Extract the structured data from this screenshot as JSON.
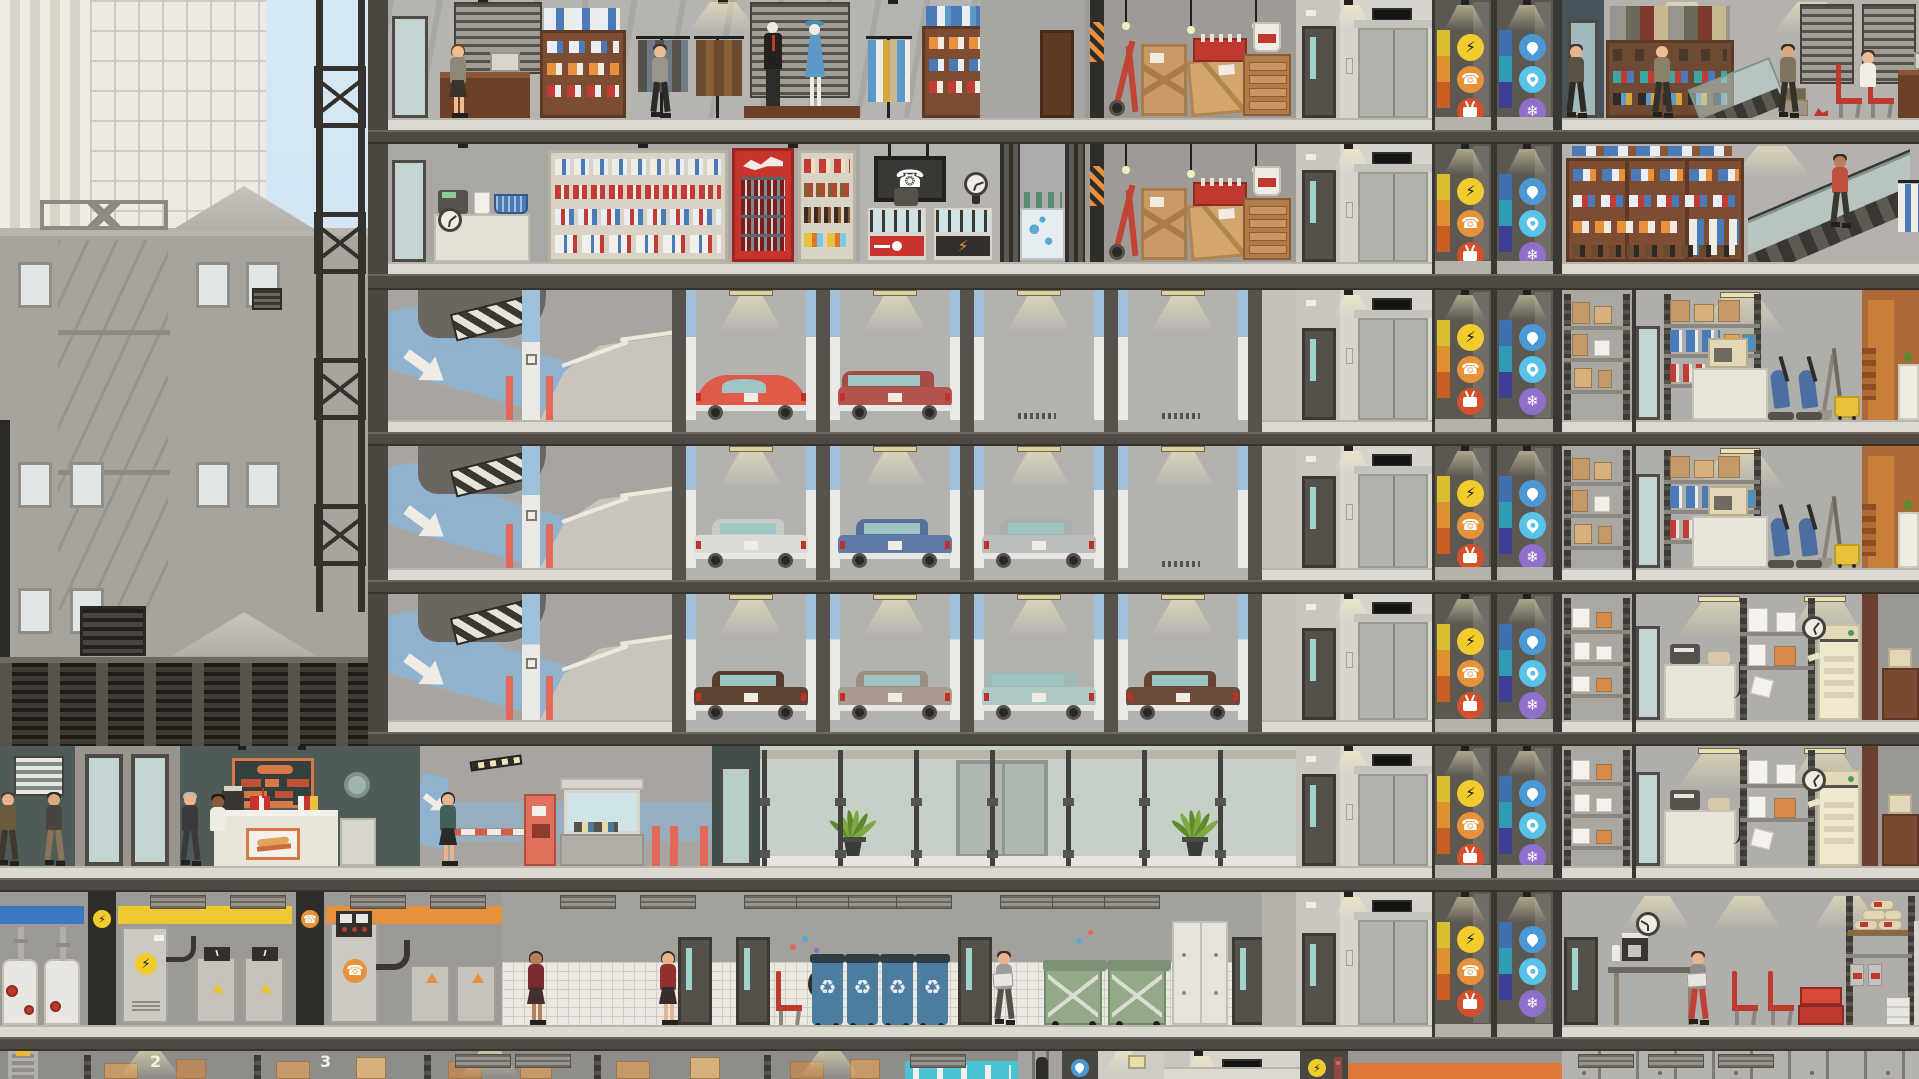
{
  "scene": {
    "title": "highrise-cross-section",
    "viewport": "building side view with city backdrop"
  },
  "storage": {
    "bays": [
      {
        "label": "2",
        "x": 150
      },
      {
        "label": "3",
        "x": 320
      },
      {
        "label": "4",
        "x": 490
      }
    ]
  },
  "risers": {
    "power": {
      "name": "electrical-riser",
      "stripes": [
        "#d9be2f",
        "#df9130",
        "#c95d22"
      ],
      "icons": [
        {
          "name": "power",
          "bg": "#f2cb2d",
          "glyph": "⚡",
          "color": "#1e1a10"
        },
        {
          "name": "phone",
          "bg": "#e5923b",
          "glyph": "☎",
          "color": "#ffffff"
        },
        {
          "name": "cable-tv",
          "bg": "#d4502a",
          "glyph": "tv",
          "color": "#ffffff"
        }
      ]
    },
    "plumbing": {
      "name": "plumbing-riser",
      "stripes": [
        "#4070b2",
        "#2f9cb4",
        "#3d4092"
      ],
      "icons": [
        {
          "name": "water",
          "bg": "#4a99d6",
          "glyph": "drop",
          "color": "#ffffff"
        },
        {
          "name": "gas",
          "bg": "#57c3e8",
          "glyph": "flame",
          "color": "#ffffff"
        },
        {
          "name": "hvac",
          "bg": "#8e6fc9",
          "glyph": "❄",
          "color": "#ffffff"
        }
      ]
    }
  },
  "parking": {
    "bay_count": 4,
    "levels": [
      {
        "name": "parking-level-1",
        "cars": [
          {
            "bay": 0,
            "style": "beetle",
            "color": "#df5a49"
          },
          {
            "bay": 1,
            "style": "wagon",
            "color": "#b2544e"
          }
        ],
        "empty_bays": [
          2,
          3
        ]
      },
      {
        "name": "parking-level-2",
        "cars": [
          {
            "bay": 0,
            "style": "sedan",
            "color": "#dbdad6"
          },
          {
            "bay": 1,
            "style": "sedan",
            "color": "#5d7aa6"
          },
          {
            "bay": 2,
            "style": "sedan",
            "color": "#babdbd"
          }
        ],
        "empty_bays": [
          3
        ]
      },
      {
        "name": "parking-level-3",
        "cars": [
          {
            "bay": 0,
            "style": "classic",
            "color": "#5f4433"
          },
          {
            "bay": 1,
            "style": "classic",
            "color": "#a99b8d"
          },
          {
            "bay": 2,
            "style": "wagon",
            "color": "#aec9c5"
          },
          {
            "bay": 3,
            "style": "classic",
            "color": "#6d4b39"
          }
        ],
        "empty_bays": []
      }
    ]
  },
  "recycling": {
    "bin_count": 4,
    "bin_color": "#4d7d9e",
    "lid_color": "#2f3d46",
    "glyph": "♻"
  },
  "trash": {
    "dumpster_count": 2,
    "dumpster_color": "#93a98a",
    "lid_color": "#7c9175"
  },
  "people": [
    {
      "floor": "f1",
      "x": 458,
      "variant": "skirt",
      "name": "clothing-clerk",
      "hair": "#6a4226",
      "skin": "#eebc92",
      "top": "#8d8878",
      "bottom": "#3a342c"
    },
    {
      "floor": "f1",
      "x": 660,
      "variant": "walk",
      "name": "clothing-shopper",
      "hair": "#3a322a",
      "skin": "#eebc92",
      "top": "#9a948a",
      "bottom": "#2c2a26"
    },
    {
      "floor": "f1",
      "x": 1576,
      "variant": "walk",
      "name": "shoe-shopper-1",
      "hair": "#3e3630",
      "skin": "#e8b48e",
      "top": "#5a5246",
      "bottom": "#2e2b26"
    },
    {
      "floor": "f1",
      "x": 1662,
      "variant": "walk",
      "name": "shoe-shopper-2",
      "hair": "#6b4a30",
      "skin": "#eebc92",
      "top": "#8a8266",
      "bottom": "#33302a"
    },
    {
      "floor": "f1",
      "x": 1788,
      "variant": "walk",
      "name": "shoe-shopper-3",
      "hair": "#2e2a26",
      "skin": "#d9a87e",
      "top": "#7d7560",
      "bottom": "#353028"
    },
    {
      "floor": "f1",
      "x": 1868,
      "variant": "half",
      "name": "shoe-cashier",
      "hair": "#3a342c",
      "skin": "#eebc92",
      "top": "#f0ede6",
      "dy": 26
    },
    {
      "floor": "f2",
      "x": 1840,
      "variant": "walk",
      "name": "escalator-rider",
      "hair": "#2e2a26",
      "skin": "#b97f5c",
      "top": "#c05040",
      "bottom": "#3a3630",
      "dy": 34
    },
    {
      "floor": "f6",
      "x": 8,
      "variant": "walk",
      "name": "pedestrian-1",
      "hair": "#4a4032",
      "skin": "#e8b48e",
      "top": "#6b5a3c",
      "bottom": "#3e382e"
    },
    {
      "floor": "f6",
      "x": 54,
      "variant": "walk",
      "name": "pedestrian-2",
      "hair": "#2e2a26",
      "skin": "#d9a87e",
      "top": "#4a4440",
      "bottom": "#8a7458"
    },
    {
      "floor": "f6",
      "x": 190,
      "variant": "walk",
      "name": "cafe-customer",
      "hair": "#b9b6b0",
      "skin": "#e8b48e",
      "top": "#3c3a38",
      "bottom": "#3c3a38"
    },
    {
      "floor": "f6",
      "x": 218,
      "variant": "half",
      "name": "cafe-server",
      "hair": "#1e1a16",
      "skin": "#8a5a3a",
      "top": "#efece4",
      "dy": 30
    },
    {
      "floor": "f6",
      "x": 448,
      "variant": "skirt",
      "name": "lobby-visitor",
      "hair": "#2c2622",
      "skin": "#e8b48e",
      "top": "#44605a",
      "bottom": "#2c2a28"
    },
    {
      "floor": "f7",
      "x": 536,
      "variant": "skirt",
      "name": "maintenance-staff-1",
      "hair": "#2c2622",
      "skin": "#b97f5c",
      "top": "#7c2b31",
      "bottom": "#452f2e"
    },
    {
      "floor": "f7",
      "x": 668,
      "variant": "skirt",
      "name": "maintenance-staff-2",
      "hair": "#2e2a26",
      "skin": "#e8b48e",
      "top": "#93302f",
      "bottom": "#3a2c2a"
    },
    {
      "floor": "f7",
      "x": 1004,
      "variant": "walk",
      "name": "janitor",
      "hair": "#3a2e24",
      "skin": "#e8b48e",
      "top": "#9c9c9a",
      "bottom": "#55524c",
      "paper": true
    },
    {
      "floor": "f7",
      "x": 1698,
      "variant": "walk",
      "name": "worker-on-break",
      "hair": "#4a3426",
      "skin": "#e8b48e",
      "top": "#8f8d88",
      "bottom": "#c23f36",
      "paper": true
    }
  ],
  "floors": [
    {
      "id": "f1",
      "rooms": [
        "clothing-store",
        "stock-room",
        "elevator-lobby",
        "electrical-riser",
        "plumbing-riser",
        "shoe-store"
      ]
    },
    {
      "id": "f2",
      "rooms": [
        "convenience-store",
        "phone-store",
        "cosmetics-stand",
        "stock-room",
        "elevator-lobby",
        "electrical-riser",
        "plumbing-riser",
        "apparel-store-with-escalator"
      ]
    },
    {
      "id": "f3",
      "rooms": [
        "parking-ramp",
        "parking-bays",
        "elevator-lobby",
        "risers",
        "supply-closet",
        "housekeeping-office",
        "cafe-sliver"
      ]
    },
    {
      "id": "f4",
      "rooms": [
        "parking-ramp",
        "parking-bays",
        "elevator-lobby",
        "risers",
        "supply-closet",
        "housekeeping-office",
        "cafe-sliver"
      ]
    },
    {
      "id": "f5",
      "rooms": [
        "parking-ramp",
        "parking-bays",
        "elevator-lobby",
        "risers",
        "paper-closet",
        "copy-room",
        "office-sliver"
      ]
    },
    {
      "id": "f6",
      "rooms": [
        "street",
        "entrance-doors",
        "sandwich-shop",
        "parking-gate",
        "glass-lobby",
        "elevator-lobby",
        "risers",
        "paper-closet",
        "copy-room",
        "office-sliver"
      ]
    },
    {
      "id": "f7",
      "rooms": [
        "pump-room",
        "electrical-room",
        "telecom-room",
        "corridor",
        "recycling-room",
        "trash-room",
        "elevator-lobby",
        "risers",
        "break-room"
      ]
    },
    {
      "id": "f8",
      "rooms": [
        "warehouse-shelving",
        "water-treatment",
        "lockers",
        "water-riser-door",
        "hall",
        "service-elevator",
        "power-riser-door",
        "cable-room",
        "cabinet-row"
      ]
    }
  ]
}
